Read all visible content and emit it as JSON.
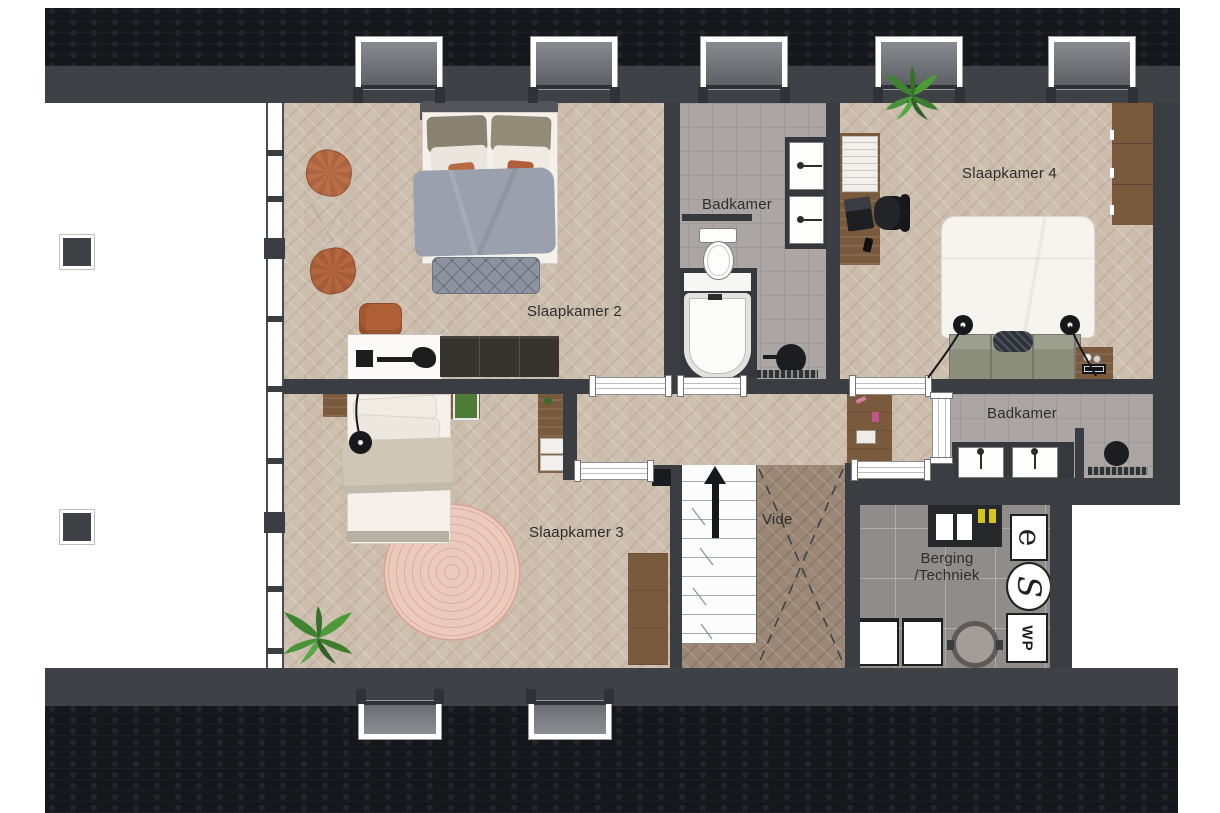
{
  "plan": {
    "type": "floor-plan",
    "language": "nl"
  },
  "rooms": {
    "slaapkamer2": {
      "label": "Slaapkamer 2"
    },
    "slaapkamer3": {
      "label": "Slaapkamer 3"
    },
    "slaapkamer4": {
      "label": "Slaapkamer 4"
    },
    "badkamer_top": {
      "label": "Badkamer"
    },
    "badkamer_right": {
      "label": "Badkamer"
    },
    "vide": {
      "label": "Vide"
    },
    "berging": {
      "line1": "Berging",
      "line2": "/Techniek"
    }
  },
  "equipment": {
    "heat_pump": "WP",
    "electric_meter": "e",
    "ventilation": "S"
  },
  "icons": {
    "up_arrow": "stairs-direction-up-triangle",
    "toilet": "oval-bowl-with-tank",
    "bathtub": "rounded-tub-in-dark-surround",
    "sink": "white-square-basin-with-faucet",
    "shower_head": "black-circle-with-drain-strip",
    "washer": "white-square-appliance",
    "boiler": "grey-circle-ring"
  },
  "colors": {
    "roof": "#16171b",
    "wall": "#3a3e43",
    "wood_floor": "#cec0b0",
    "vide_floor": "#9b8775",
    "tile_floor": "#aba6a4",
    "berging_floor": "#8f8c8b",
    "rug": "#ecc8bb",
    "pouf": "#bc6f47",
    "plant": "#4a8f31",
    "wood_furniture": "#7a5a3d"
  }
}
